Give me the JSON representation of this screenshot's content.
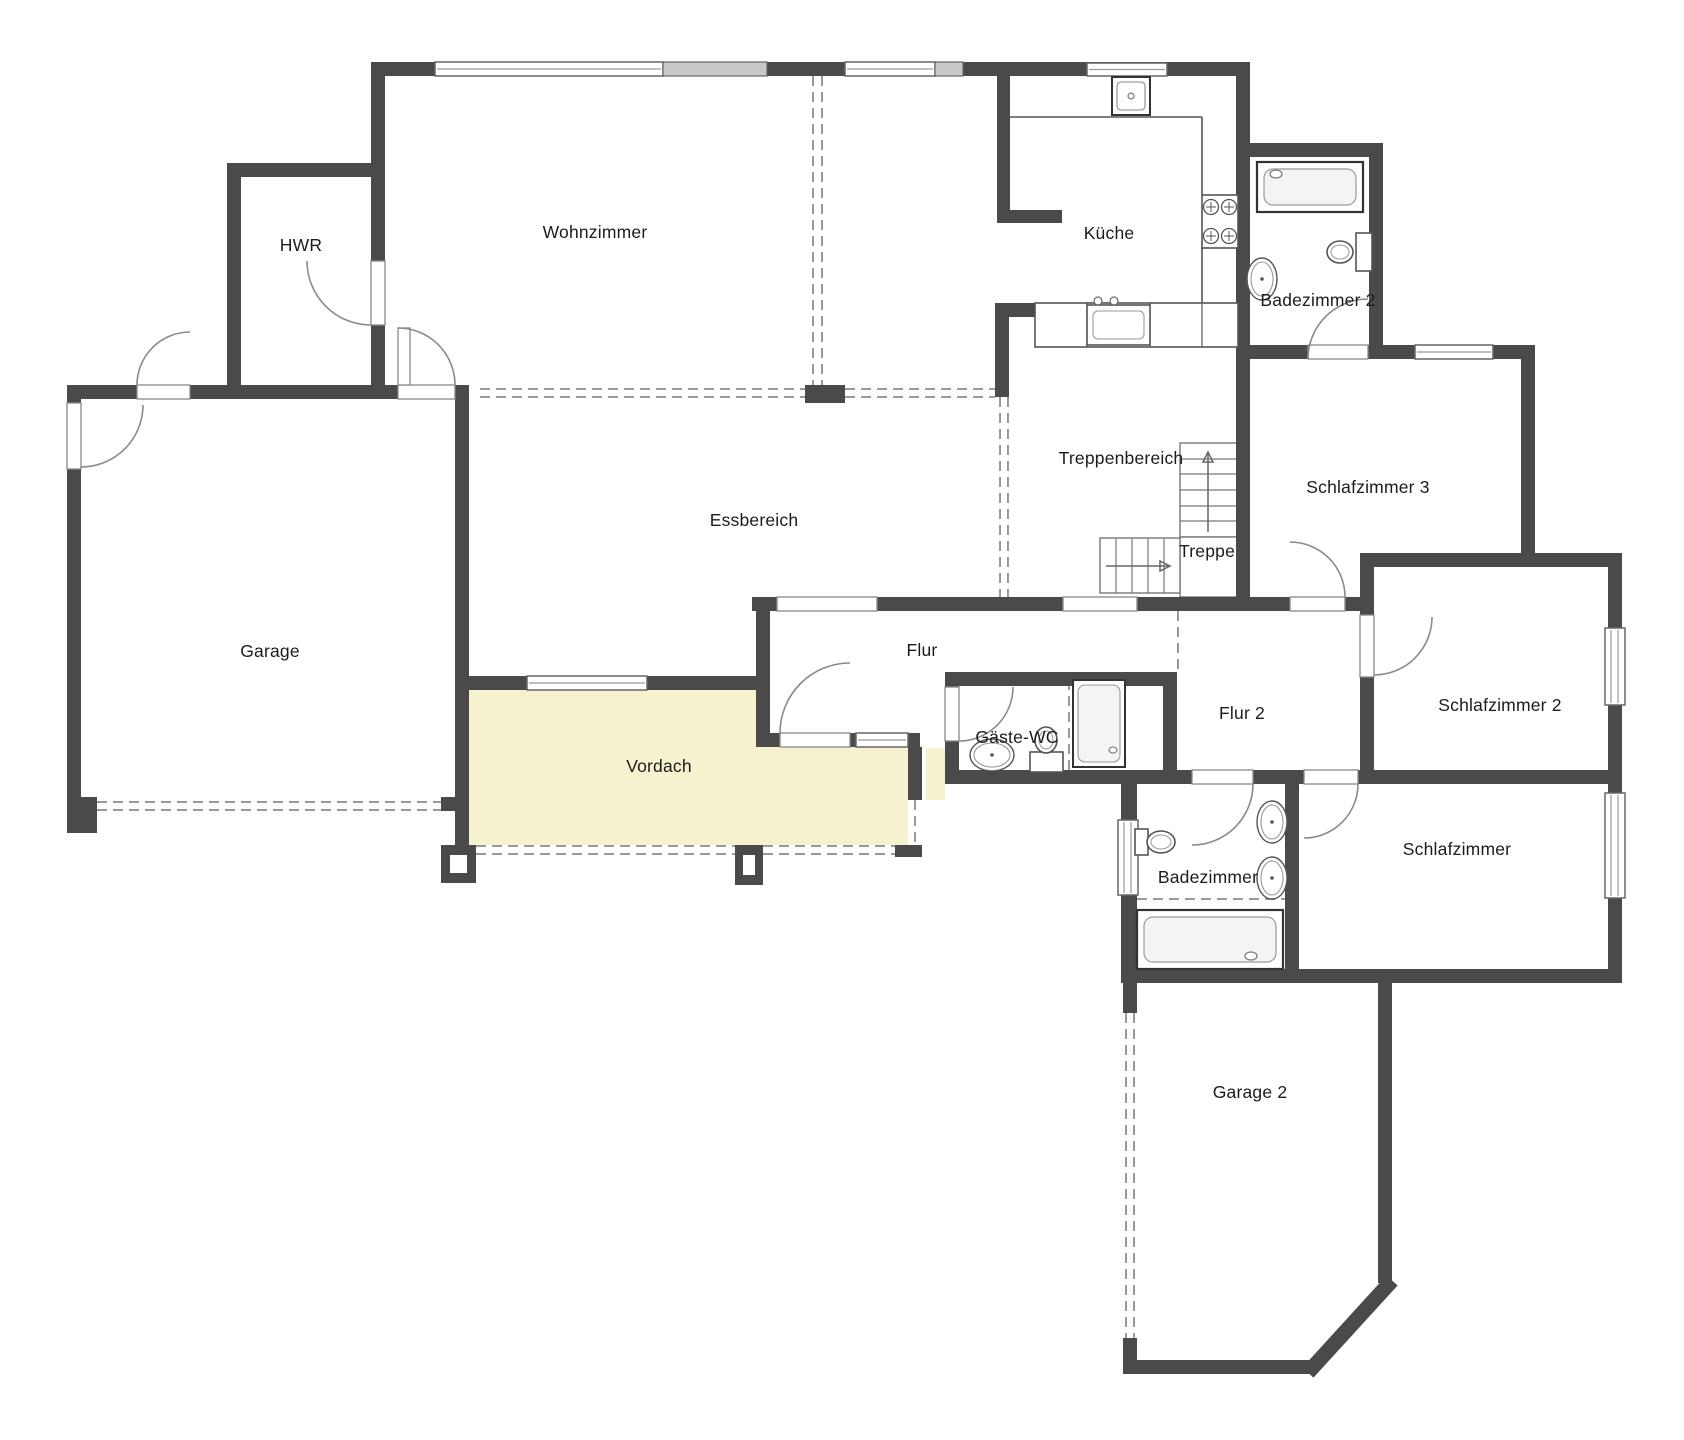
{
  "meta": {
    "type": "floorplan",
    "language": "de",
    "canvas": {
      "width": 1684,
      "height": 1440
    }
  },
  "colors": {
    "background": "#ffffff",
    "wall": "#4a4a4a",
    "window_frame": "#666666",
    "window_gray_fill": "#c9c9c9",
    "door_arc": "#8a8a8a",
    "dashed_line": "#9a9a9a",
    "fixture_stroke": "#555555",
    "fixture_inner": "#8a8a8a",
    "vordach_fill": "#f6f1cf",
    "label_color": "#1c1c1c"
  },
  "rooms": [
    {
      "name": "hwr",
      "label": "HWR",
      "x": 301,
      "y": 251
    },
    {
      "name": "wohnzimmer",
      "label": "Wohnzimmer",
      "x": 595,
      "y": 238
    },
    {
      "name": "kueche",
      "label": "Küche",
      "x": 1109,
      "y": 239
    },
    {
      "name": "badezimmer-2",
      "label": "Badezimmer 2",
      "x": 1318,
      "y": 306
    },
    {
      "name": "treppenbereich",
      "label": "Treppenbereich",
      "x": 1121,
      "y": 464
    },
    {
      "name": "schlafzimmer-3",
      "label": "Schlafzimmer 3",
      "x": 1368,
      "y": 493
    },
    {
      "name": "treppe",
      "label": "Treppe",
      "x": 1207,
      "y": 557
    },
    {
      "name": "essbereich",
      "label": "Essbereich",
      "x": 754,
      "y": 526
    },
    {
      "name": "garage",
      "label": "Garage",
      "x": 270,
      "y": 657
    },
    {
      "name": "flur",
      "label": "Flur",
      "x": 922,
      "y": 656
    },
    {
      "name": "flur-2",
      "label": "Flur 2",
      "x": 1242,
      "y": 719
    },
    {
      "name": "schlafzimmer-2",
      "label": "Schlafzimmer 2",
      "x": 1500,
      "y": 711
    },
    {
      "name": "gaeste-wc",
      "label": "Gäste-WC",
      "x": 1017,
      "y": 743
    },
    {
      "name": "vordach",
      "label": "Vordach",
      "x": 659,
      "y": 772
    },
    {
      "name": "badezimmer",
      "label": "Badezimmer",
      "x": 1208,
      "y": 883
    },
    {
      "name": "schlafzimmer",
      "label": "Schlafzimmer",
      "x": 1457,
      "y": 855
    },
    {
      "name": "garage-2",
      "label": "Garage 2",
      "x": 1250,
      "y": 1098
    }
  ],
  "areas": [
    {
      "name": "vordach-canopy",
      "points": "469,690 756,690 756,747 908,747 908,845 469,845",
      "fill": "vordach_fill"
    },
    {
      "name": "vordach-sliver",
      "points": "926,748 945,748 945,800 926,800",
      "fill": "vordach_fill"
    }
  ],
  "walls": [
    [
      371,
      62,
      879,
      14
    ],
    [
      227,
      163,
      158,
      14
    ],
    [
      67,
      385,
      70,
      14
    ],
    [
      190,
      385,
      208,
      14
    ],
    [
      455,
      385,
      14,
      14
    ],
    [
      227,
      163,
      14,
      236
    ],
    [
      371,
      62,
      14,
      337
    ],
    [
      67,
      385,
      14,
      448
    ],
    [
      455,
      385,
      14,
      460
    ],
    [
      995,
      303,
      40,
      14
    ],
    [
      995,
      303,
      14,
      94
    ],
    [
      997,
      75,
      13,
      148
    ],
    [
      997,
      210,
      65,
      13
    ],
    [
      1236,
      62,
      14,
      549
    ],
    [
      1236,
      143,
      147,
      14
    ],
    [
      1369,
      143,
      14,
      216
    ],
    [
      1236,
      345,
      72,
      14
    ],
    [
      1368,
      345,
      47,
      14
    ],
    [
      1493,
      345,
      42,
      14
    ],
    [
      1521,
      345,
      14,
      222
    ],
    [
      1360,
      553,
      262,
      14
    ],
    [
      1360,
      553,
      14,
      62
    ],
    [
      1360,
      677,
      14,
      107
    ],
    [
      1608,
      553,
      14,
      75
    ],
    [
      1608,
      705,
      14,
      88
    ],
    [
      1608,
      898,
      14,
      85
    ],
    [
      1243,
      597,
      47,
      14
    ],
    [
      1345,
      597,
      29,
      14
    ],
    [
      752,
      597,
      25,
      14
    ],
    [
      877,
      597,
      186,
      14
    ],
    [
      1137,
      597,
      113,
      14
    ],
    [
      756,
      611,
      14,
      136
    ],
    [
      756,
      733,
      24,
      14
    ],
    [
      850,
      733,
      6,
      14
    ],
    [
      908,
      733,
      12,
      14
    ],
    [
      908,
      747,
      14,
      53
    ],
    [
      945,
      672,
      232,
      14
    ],
    [
      945,
      672,
      14,
      15
    ],
    [
      945,
      741,
      14,
      43
    ],
    [
      1163,
      672,
      14,
      112
    ],
    [
      945,
      770,
      247,
      14
    ],
    [
      1253,
      770,
      51,
      14
    ],
    [
      1358,
      770,
      264,
      14
    ],
    [
      1121,
      770,
      16,
      50
    ],
    [
      1121,
      895,
      16,
      88
    ],
    [
      1285,
      770,
      14,
      213
    ],
    [
      1121,
      969,
      501,
      14
    ],
    [
      67,
      797,
      30,
      14
    ],
    [
      441,
      797,
      28,
      14
    ],
    [
      469,
      676,
      58,
      14
    ],
    [
      647,
      676,
      109,
      14
    ],
    [
      1378,
      983,
      14,
      300
    ],
    [
      1123,
      983,
      14,
      30
    ],
    [
      1123,
      1338,
      14,
      36
    ],
    [
      1123,
      1360,
      193,
      14
    ]
  ],
  "chamfer": [
    1313,
    1367,
    1387,
    1286
  ],
  "posts": [
    {
      "rect": [
        805,
        385,
        40,
        18
      ],
      "inner": null
    },
    {
      "rect": [
        67,
        797,
        30,
        36
      ],
      "inner": null
    },
    {
      "rect": [
        441,
        845,
        35,
        38
      ],
      "inner": [
        450,
        855,
        17,
        18
      ]
    },
    {
      "rect": [
        735,
        845,
        28,
        40
      ],
      "inner": [
        743,
        855,
        12,
        20
      ]
    },
    {
      "rect": [
        895,
        845,
        27,
        12
      ],
      "inner": null
    }
  ],
  "windows_white": [
    [
      435,
      62,
      228,
      14
    ],
    [
      845,
      62,
      90,
      14
    ],
    [
      1087,
      63,
      80,
      13
    ],
    [
      1415,
      345,
      78,
      14
    ],
    [
      527,
      676,
      120,
      14
    ],
    [
      856,
      733,
      52,
      14
    ],
    [
      1605,
      628,
      20,
      77
    ],
    [
      1605,
      793,
      20,
      105
    ],
    [
      1118,
      820,
      20,
      75
    ]
  ],
  "windows_gray": [
    [
      663,
      62,
      104,
      14
    ],
    [
      935,
      62,
      28,
      14
    ]
  ],
  "door_sills": [
    [
      67,
      403,
      14,
      66
    ],
    [
      137,
      385,
      53,
      14
    ],
    [
      398,
      385,
      57,
      14
    ],
    [
      371,
      261,
      14,
      64
    ],
    [
      1308,
      345,
      60,
      14
    ],
    [
      1290,
      597,
      55,
      14
    ],
    [
      1360,
      615,
      14,
      62
    ],
    [
      1192,
      770,
      61,
      14
    ],
    [
      1304,
      770,
      54,
      14
    ],
    [
      780,
      733,
      70,
      14
    ],
    [
      945,
      687,
      14,
      54
    ],
    [
      777,
      597,
      100,
      14
    ],
    [
      1063,
      597,
      74,
      14
    ]
  ],
  "door_leaves": [
    [
      398,
      328,
      12,
      57
    ]
  ],
  "door_arcs": [
    {
      "cx": 81,
      "cy": 405,
      "r": 62,
      "a1": 90,
      "a2": 0
    },
    {
      "cx": 190,
      "cy": 385,
      "r": 53,
      "a1": 180,
      "a2": 270
    },
    {
      "cx": 398,
      "cy": 385,
      "r": 57,
      "a1": 0,
      "a2": 270
    },
    {
      "cx": 371,
      "cy": 261,
      "r": 64,
      "a1": 90,
      "a2": 180
    },
    {
      "cx": 1368,
      "cy": 359,
      "r": 60,
      "a1": 180,
      "a2": 270
    },
    {
      "cx": 1290,
      "cy": 597,
      "r": 55,
      "a1": 0,
      "a2": 270
    },
    {
      "cx": 1374,
      "cy": 617,
      "r": 58,
      "a1": 90,
      "a2": 0
    },
    {
      "cx": 1192,
      "cy": 784,
      "r": 61,
      "a1": 0,
      "a2": 90
    },
    {
      "cx": 1304,
      "cy": 784,
      "r": 54,
      "a1": 0,
      "a2": 90
    },
    {
      "cx": 850,
      "cy": 733,
      "r": 70,
      "a1": 180,
      "a2": 270
    },
    {
      "cx": 959,
      "cy": 687,
      "r": 54,
      "a1": 90,
      "a2": 0
    }
  ],
  "dashed_lines": [
    [
      813,
      76,
      813,
      385
    ],
    [
      822,
      76,
      822,
      385
    ],
    [
      480,
      389,
      805,
      389
    ],
    [
      480,
      397,
      805,
      397
    ],
    [
      845,
      389,
      995,
      389
    ],
    [
      845,
      397,
      995,
      397
    ],
    [
      1000,
      397,
      1000,
      597
    ],
    [
      1008,
      397,
      1008,
      597
    ],
    [
      97,
      802,
      441,
      802
    ],
    [
      97,
      810,
      441,
      810
    ],
    [
      476,
      846,
      735,
      846
    ],
    [
      476,
      854,
      735,
      854
    ],
    [
      763,
      846,
      895,
      846
    ],
    [
      763,
      854,
      895,
      854
    ],
    [
      1126,
      1013,
      1126,
      1338
    ],
    [
      1134,
      1013,
      1134,
      1338
    ],
    [
      1178,
      611,
      1178,
      672
    ],
    [
      1069,
      680,
      1069,
      770
    ],
    [
      1137,
      899,
      1285,
      899
    ],
    [
      915,
      800,
      915,
      845
    ]
  ],
  "stairs": {
    "upper": {
      "x": 1180,
      "y": 443,
      "w": 57,
      "h": 94,
      "treads_y": [
        459,
        474,
        490,
        506,
        521
      ]
    },
    "landing": {
      "x": 1180,
      "y": 537,
      "w": 57,
      "h": 60
    },
    "lower": {
      "x": 1100,
      "y": 538,
      "w": 80,
      "h": 55,
      "treads_x": [
        1116,
        1132,
        1148,
        1164
      ]
    },
    "arrow_up": {
      "x": 1208,
      "y1": 532,
      "y2": 452
    },
    "arrow_right": {
      "y": 566,
      "x1": 1106,
      "x2": 1170
    }
  },
  "fixtures": {
    "bathtubs": [
      {
        "x": 1257,
        "y": 162,
        "w": 106,
        "h": 50,
        "faucet": [
          1276,
          174
        ]
      },
      {
        "x": 1137,
        "y": 910,
        "w": 146,
        "h": 59,
        "faucet": [
          1251,
          956
        ]
      }
    ],
    "toilets": [
      {
        "tank": [
          1356,
          233,
          16,
          38
        ],
        "bowl": [
          1340,
          252,
          13,
          11
        ]
      },
      {
        "tank": [
          1030,
          752,
          33,
          20
        ],
        "bowl": [
          1046,
          740,
          11,
          13
        ]
      },
      {
        "tank": [
          1135,
          829,
          13,
          26
        ],
        "bowl": [
          1161,
          842,
          14,
          11
        ]
      }
    ],
    "sinks": [
      [
        1262,
        279,
        11,
        17
      ],
      [
        992,
        755,
        18,
        12
      ],
      [
        1272,
        822,
        11,
        17
      ],
      [
        1272,
        878,
        11,
        17
      ]
    ],
    "showers": [
      {
        "x": 1073,
        "y": 680,
        "w": 52,
        "h": 87,
        "drain": [
          1113,
          750
        ]
      }
    ],
    "kitchen": {
      "sink_top": {
        "x": 1112,
        "y": 77,
        "w": 38,
        "h": 38
      },
      "counter_lines": [
        [
          1010,
          117,
          1202,
          117
        ],
        [
          1202,
          117,
          1202,
          195
        ],
        [
          1202,
          248,
          1202,
          303
        ]
      ],
      "counter_bottom": {
        "x": 1035,
        "y": 303,
        "w": 203,
        "h": 44,
        "dividers": [
          1087,
          1150,
          1202
        ],
        "sink": {
          "x": 1087,
          "y": 305,
          "w": 63,
          "h": 40
        },
        "faucets": [
          [
            1098,
            301
          ],
          [
            1114,
            301
          ]
        ]
      },
      "stove": {
        "x": 1202,
        "y": 195,
        "w": 36,
        "h": 53,
        "burners": [
          [
            1211,
            207
          ],
          [
            1229,
            207
          ],
          [
            1211,
            236
          ],
          [
            1229,
            236
          ]
        ]
      }
    }
  }
}
